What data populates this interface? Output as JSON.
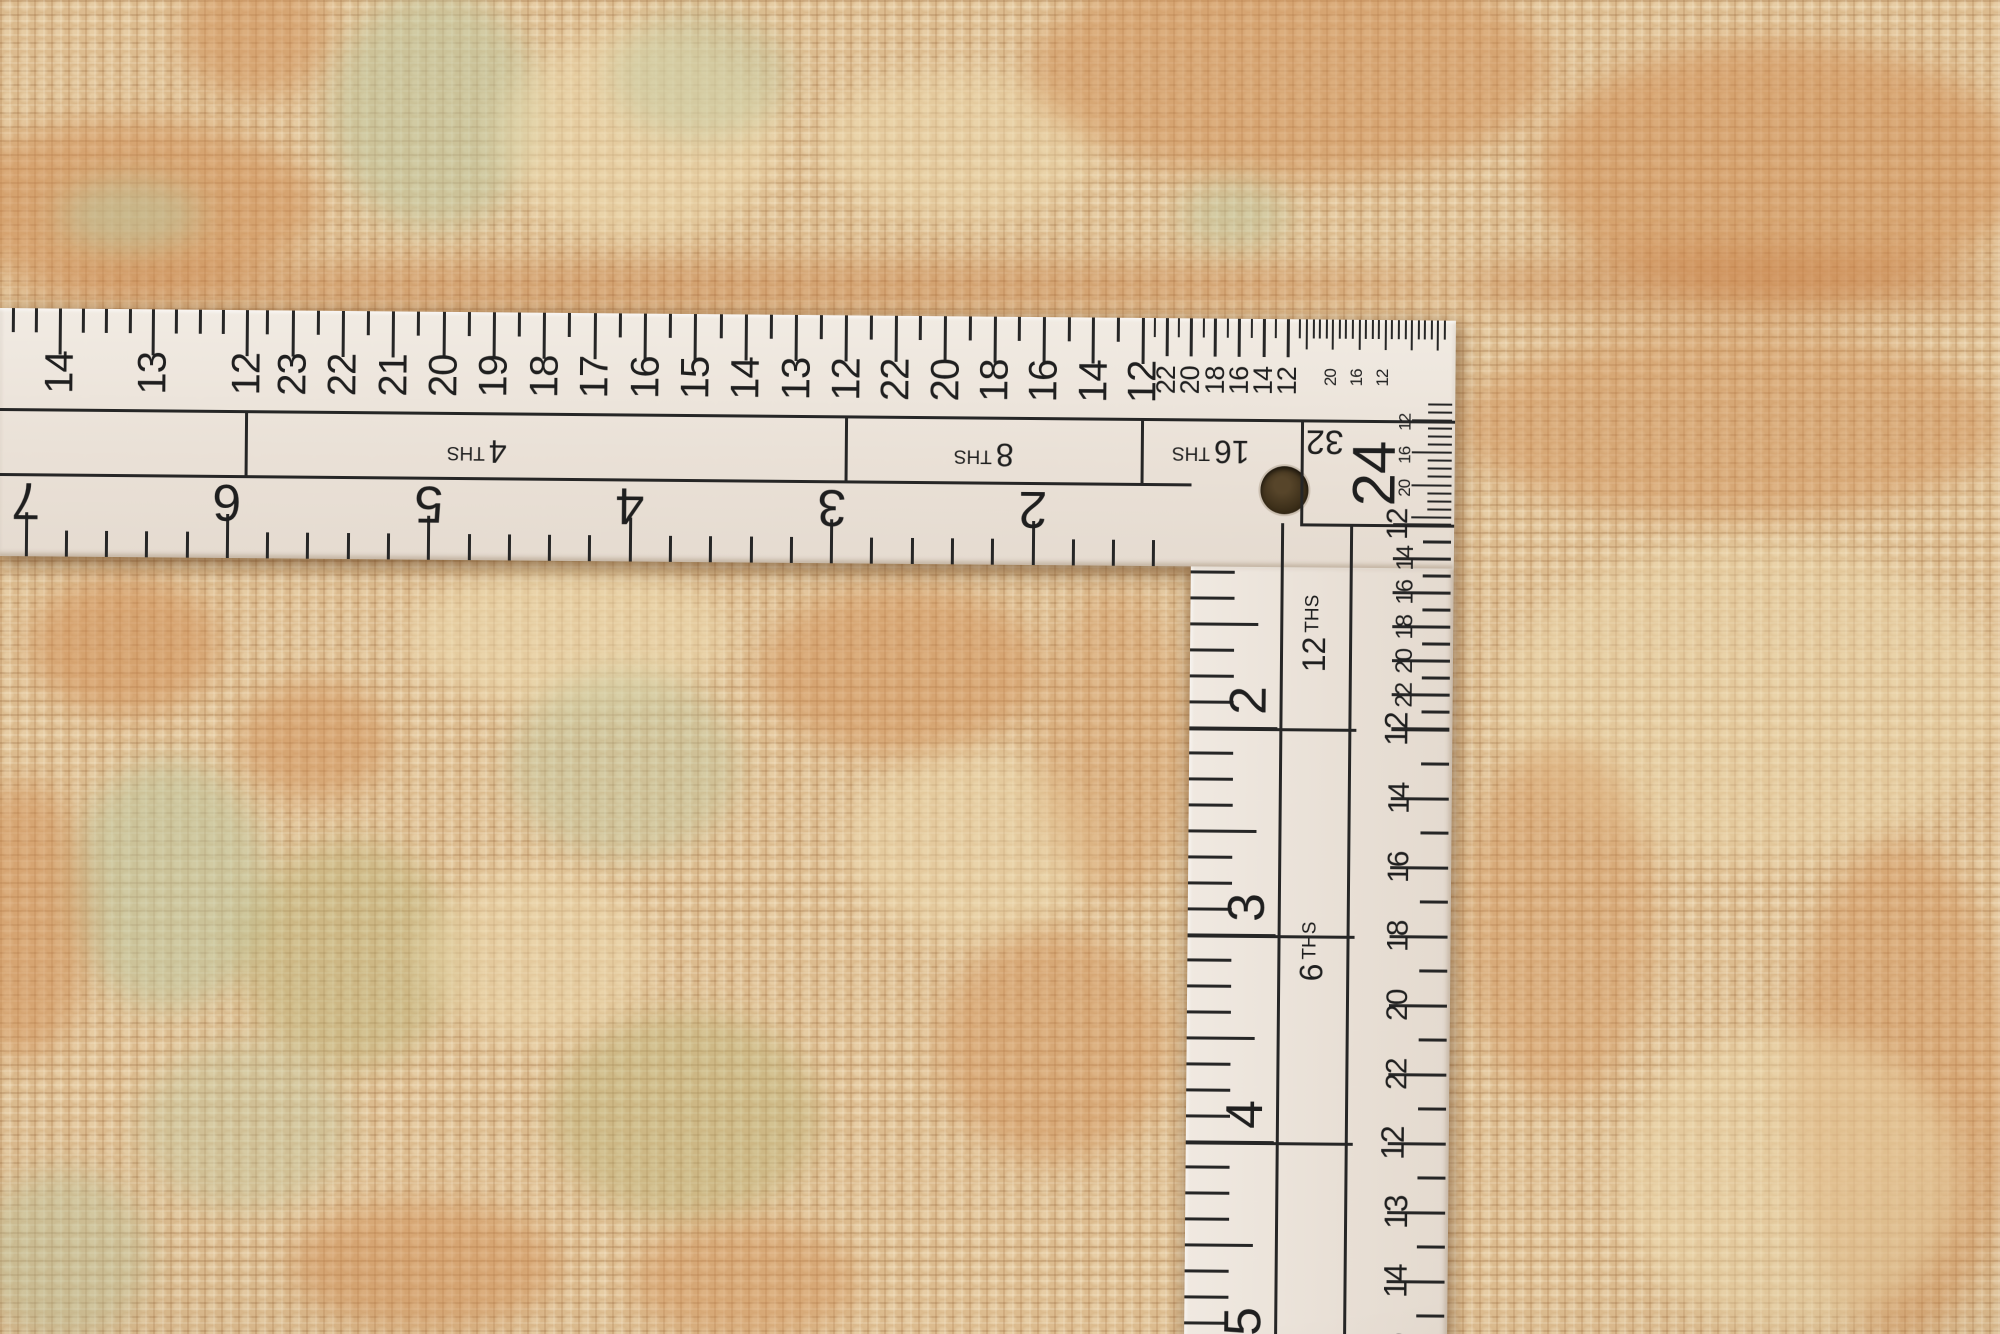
{
  "colors": {
    "ruler_face": "#ece4db",
    "ink": "#262626",
    "hole": "#3a2d18",
    "carpet_base": "#dcbb8e",
    "carpet_orange": "#cf8a50",
    "carpet_deep_orange": "#c3763c",
    "carpet_sage": "#bcc9a2",
    "carpet_olive": "#b7b377",
    "carpet_cream": "#eedcb0"
  },
  "horizontal_arm": {
    "lead_numbers": [
      "14",
      "13",
      "12"
    ],
    "sections": [
      {
        "label_value": "4",
        "label_suffix": "THS",
        "numbers": [
          "23",
          "22",
          "21",
          "20",
          "19",
          "18",
          "17",
          "16",
          "15",
          "14",
          "13",
          "12"
        ]
      },
      {
        "label_value": "8",
        "label_suffix": "THS",
        "numbers": [
          "22",
          "20",
          "18",
          "16",
          "14",
          "12"
        ]
      },
      {
        "label_value": "16",
        "label_suffix": "THS",
        "numbers": [
          "22",
          "20",
          "18",
          "16",
          "14",
          "12"
        ]
      },
      {
        "label_value": "32",
        "label_suffix": "",
        "numbers": [
          "20",
          "16",
          "12"
        ]
      }
    ],
    "unit_numbers": [
      "7",
      "6",
      "5",
      "4",
      "3",
      "2"
    ]
  },
  "vertical_arm": {
    "corner_number": "24",
    "corner_scale_numbers": [
      "12",
      "16",
      "20"
    ],
    "unit_numbers": [
      "2",
      "3",
      "4",
      "5"
    ],
    "section_labels": [
      {
        "label_value": "12",
        "label_suffix": "THS"
      },
      {
        "label_value": "6",
        "label_suffix": "THS"
      }
    ],
    "right_scale_sections": [
      {
        "start_number": "12",
        "numbers": [
          "14",
          "16",
          "18",
          "20",
          "22"
        ]
      },
      {
        "start_number": "12",
        "numbers": [
          "14",
          "16",
          "18",
          "20",
          "22"
        ]
      },
      {
        "start_number": "12",
        "numbers": [
          "13",
          "14",
          "15"
        ]
      }
    ]
  }
}
